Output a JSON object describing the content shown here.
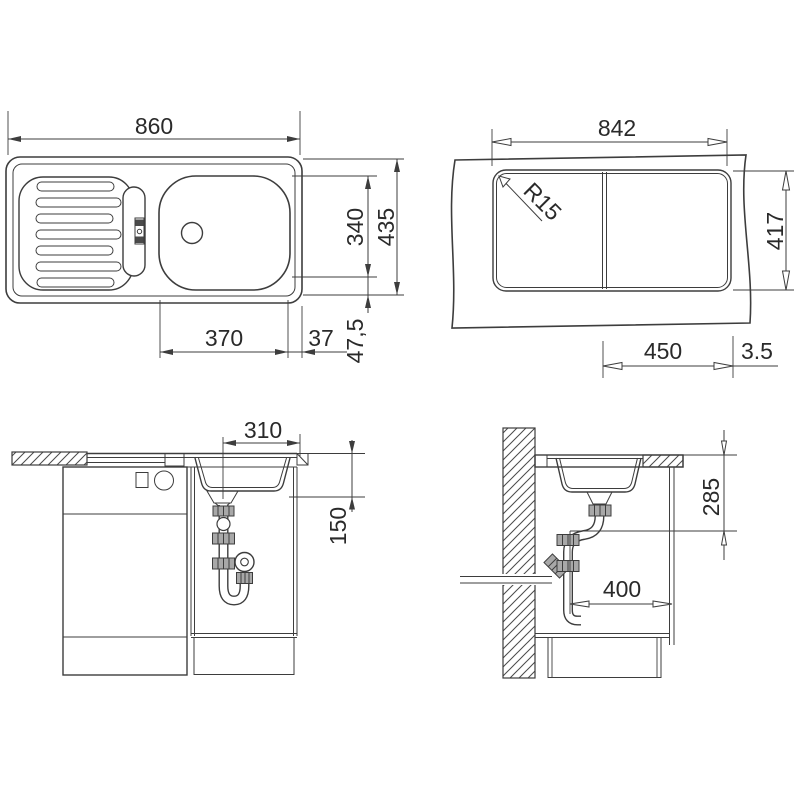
{
  "views": {
    "top": {
      "label": "sink top view",
      "dims": {
        "overall_width": "860",
        "bowl_height": "340",
        "overall_height": "435",
        "bowl_width": "370",
        "bowl_right_offset": "37",
        "bowl_bottom_offset": "47,5"
      }
    },
    "cutout": {
      "label": "worktop cutout view",
      "dims": {
        "cutout_width": "842",
        "corner_radius": "R15",
        "cutout_height": "417",
        "bowl_section_width": "450",
        "divider_gap": "3.5"
      }
    },
    "front": {
      "label": "front section view",
      "dims": {
        "drain_to_edge": "310",
        "drain_depth": "150"
      }
    },
    "side": {
      "label": "side section view",
      "dims": {
        "outlet_height": "285",
        "outlet_to_cabinet": "400"
      }
    }
  },
  "colors": {
    "line": "#3d3d3d",
    "text": "#2a2a2a",
    "background": "#ffffff"
  }
}
